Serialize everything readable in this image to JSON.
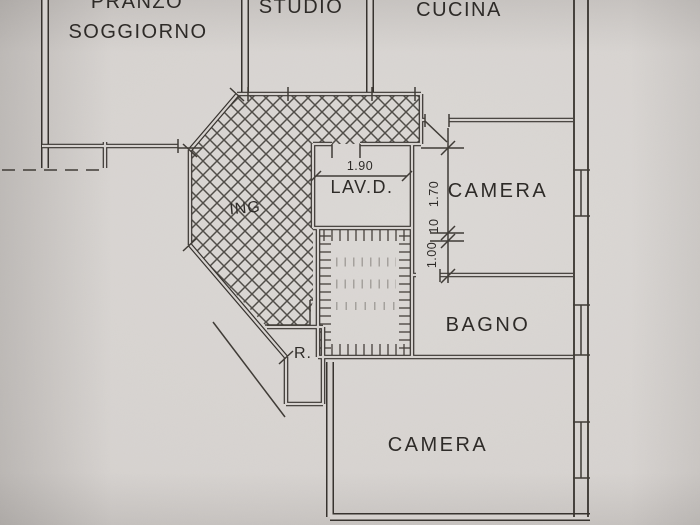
{
  "drawing": {
    "kind": "apartment floor plan (photographed paper drawing)",
    "colors": {
      "paper": "#d6d3d0",
      "ink": "#37332f",
      "text": "#2e2b28"
    }
  },
  "rooms": {
    "pranzo_soggiorno": {
      "label_line1": "PRANZO",
      "label_line2": "SOGGIORNO"
    },
    "studio": {
      "label": "STUDIO"
    },
    "cucina": {
      "label": "CUCINA"
    },
    "ingresso": {
      "label": "ING"
    },
    "lavanderia": {
      "label": "LAV.D."
    },
    "camera_top": {
      "label": "CAMERA"
    },
    "bagno": {
      "label": "BAGNO"
    },
    "camera_bottom": {
      "label": "CAMERA"
    },
    "ripostiglio": {
      "label": "R."
    }
  },
  "dimensions": {
    "lavd_width": "1.90",
    "span_long": "1.70",
    "wall_thickness": "10",
    "span_short": "1.00"
  }
}
